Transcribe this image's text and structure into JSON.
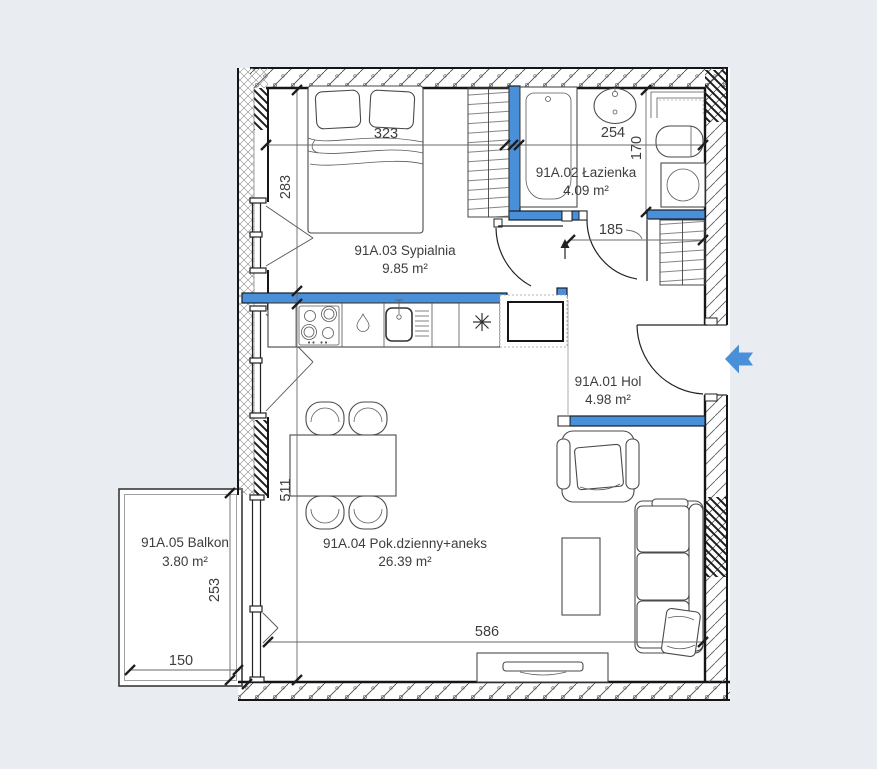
{
  "plan": {
    "title": "apartment-floor-plan",
    "rooms": [
      {
        "id": "91A.03",
        "name": "91A.03 Sypialnia",
        "area": "9.85 m²"
      },
      {
        "id": "91A.02",
        "name": "91A.02 Łazienka",
        "area": "4.09 m²"
      },
      {
        "id": "91A.01",
        "name": "91A.01 Hol",
        "area": "4.98 m²"
      },
      {
        "id": "91A.04",
        "name": "91A.04 Pok.dzienny+aneks",
        "area": "26.39 m²"
      },
      {
        "id": "91A.05",
        "name": "91A.05 Balkon",
        "area": "3.80 m²"
      }
    ],
    "dimensions": {
      "bedroom_width": "323",
      "bedroom_depth": "283",
      "bathroom_width": "254",
      "bathroom_depth": "170",
      "hall_width": "185",
      "living_depth": "511",
      "living_width": "586",
      "balcony_depth": "253",
      "balcony_width": "150"
    },
    "colors": {
      "accent_blue": "#4a90d9",
      "background": "#e9edf2",
      "line": "#161616",
      "label": "#3d3d3d"
    },
    "icons": {
      "entrance_arrow": "left-block-arrow"
    }
  }
}
